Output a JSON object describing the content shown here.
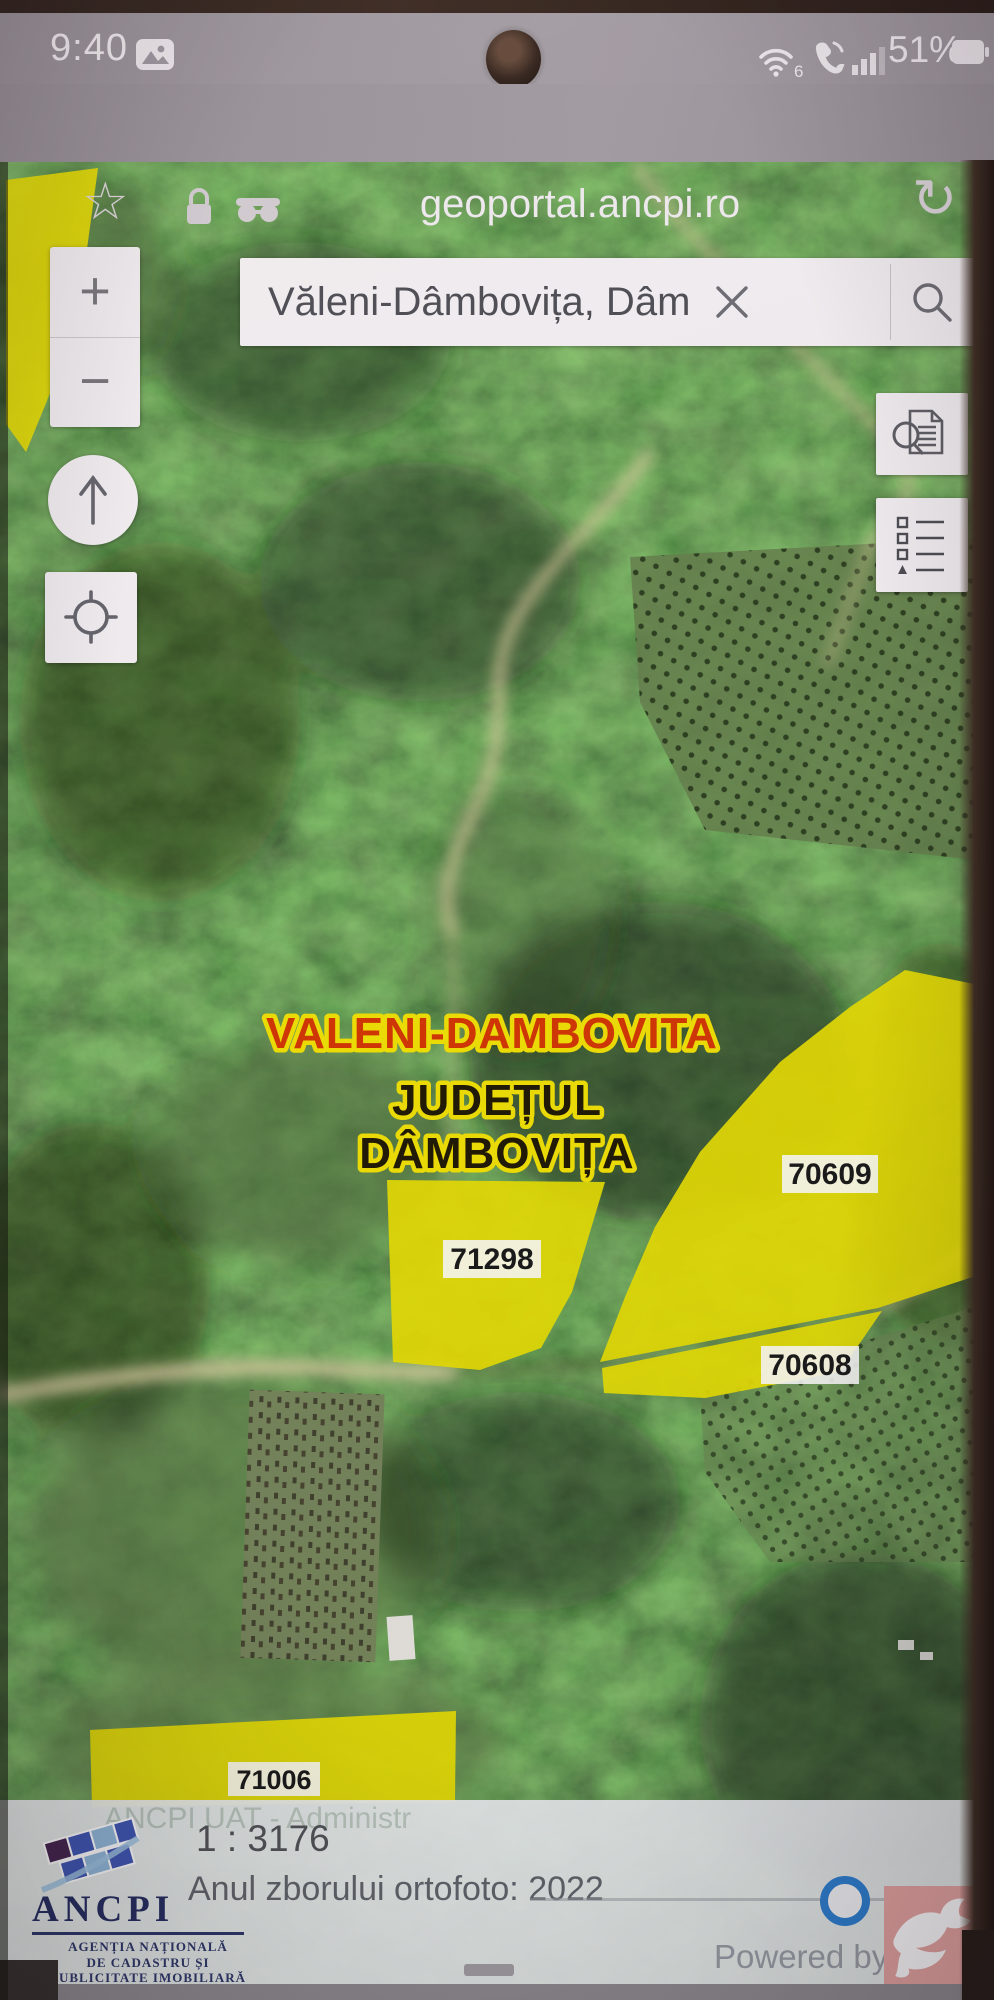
{
  "status_bar": {
    "time": "9:40",
    "battery": "51%",
    "wifi_badge": "6"
  },
  "browser": {
    "url": "geoportal.ancpi.ro"
  },
  "icons": {
    "star": "☆",
    "refresh": "↻",
    "zoom_in": "+",
    "zoom_out": "−"
  },
  "map": {
    "search": {
      "value": "Văleni-Dâmbovița, Dâm"
    },
    "labels": {
      "locality": "VALENI-DAMBOVITA",
      "county_line1": "JUDEȚUL",
      "county_line2": "DÂMBOVIȚA"
    },
    "parcels": [
      "70609",
      "71298",
      "70608",
      "71006"
    ],
    "colors": {
      "parcel_yellow": "#e9e000",
      "locality_red": "#d43400",
      "label_outline": "#f2e200",
      "accent_blue": "#2b7fd2"
    }
  },
  "footer": {
    "watermark": "ANCPI UAT - Administr",
    "scale": "1 : 3176",
    "flight_year": "Anul zborului ortofoto: 2022",
    "powered_by": "Powered by",
    "logo": {
      "name": "ANCPI",
      "line1": "AGENȚIA NAȚIONALĂ",
      "line2": "DE CADASTRU ȘI",
      "line3": "PUBLICITATE IMOBILIARĂ"
    }
  }
}
